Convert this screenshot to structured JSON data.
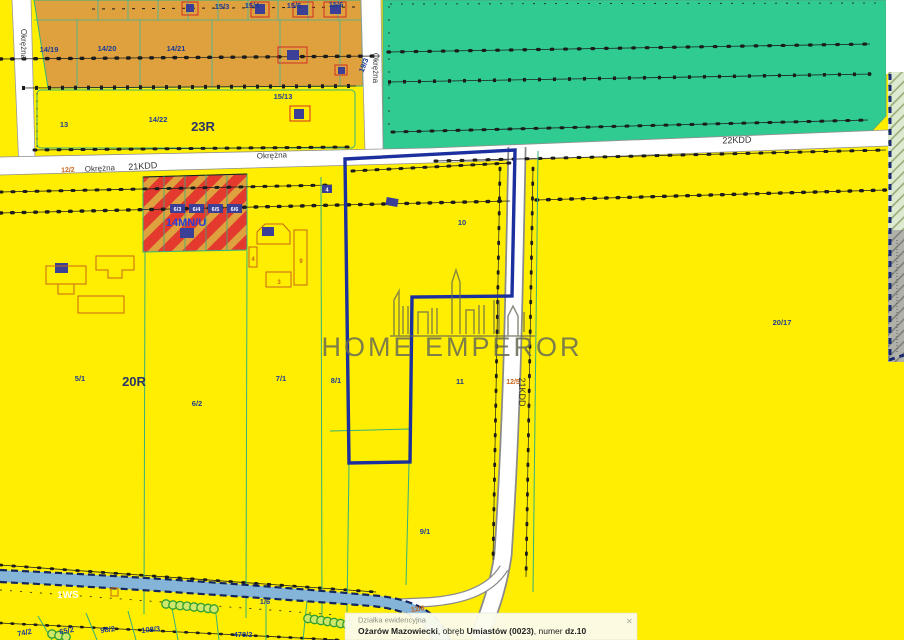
{
  "labels": {
    "okrezna_left": "Okrężna",
    "okrezna_mid": "Okrężna",
    "okrezna_h1": "Okrężna",
    "okrezna_h2": "Okrężna",
    "road_12_2": "12/2",
    "kdd21_h": "21KDD",
    "kdd21_v": "21KDD",
    "kdd22": "22KDD",
    "p14_19": "14/19",
    "p14_20": "14/20",
    "p14_21": "14/21",
    "p15_3": "15/3",
    "p15_4": "15/4",
    "p15_5": "15/5",
    "p15_6": "15/6",
    "p15_13": "15/13",
    "p19_3": "19/3",
    "p13": "13",
    "p14_22": "14/22",
    "z23R": "23R",
    "z14MNU": "14MN/U",
    "b6_3": "6/3",
    "b6_4": "6/4",
    "b6_5": "6/5",
    "b6_6": "6/6",
    "b4": "4",
    "b4_small": "4",
    "b3": "3",
    "b9": "9",
    "p5_1": "5/1",
    "z20R": "20R",
    "p6_2": "6/2",
    "p7_1": "7/1",
    "p8_1": "8/1",
    "p10": "10",
    "p11": "11",
    "p12_5": "12/5",
    "p20_17": "20/17",
    "p9_1": "9/1",
    "z1WS": "1WS",
    "p1_6": "1/6",
    "p12_6": "12/6",
    "p74_2": "74/2",
    "p65_2": "65/2",
    "p98_2": "98/2",
    "p108_3": "108/3",
    "p470_2": "470/2"
  },
  "watermark": {
    "text": "HOME EMPEROR"
  },
  "info_panel": {
    "title": "Działka ewidencyjna",
    "city": "Ożarów Mazowiecki",
    "sep1": ", obręb ",
    "district": "Umiastów (0023)",
    "sep2": ", numer ",
    "number": "dz.10",
    "close_glyph": "✕"
  },
  "colors": {
    "zone_yellow": "#ffee00",
    "zone_orange": "#dfa13d",
    "zone_green": "#2fcb90",
    "stripe_red": "#e4392e",
    "water_blue": "#84b5d8",
    "parcel_line_teal": "#35b07e",
    "selected_parcel_navy": "#1b2f9e",
    "label_navy": "#1e3c96",
    "label_orange": "#c9661a",
    "road_white": "#ffffff"
  }
}
